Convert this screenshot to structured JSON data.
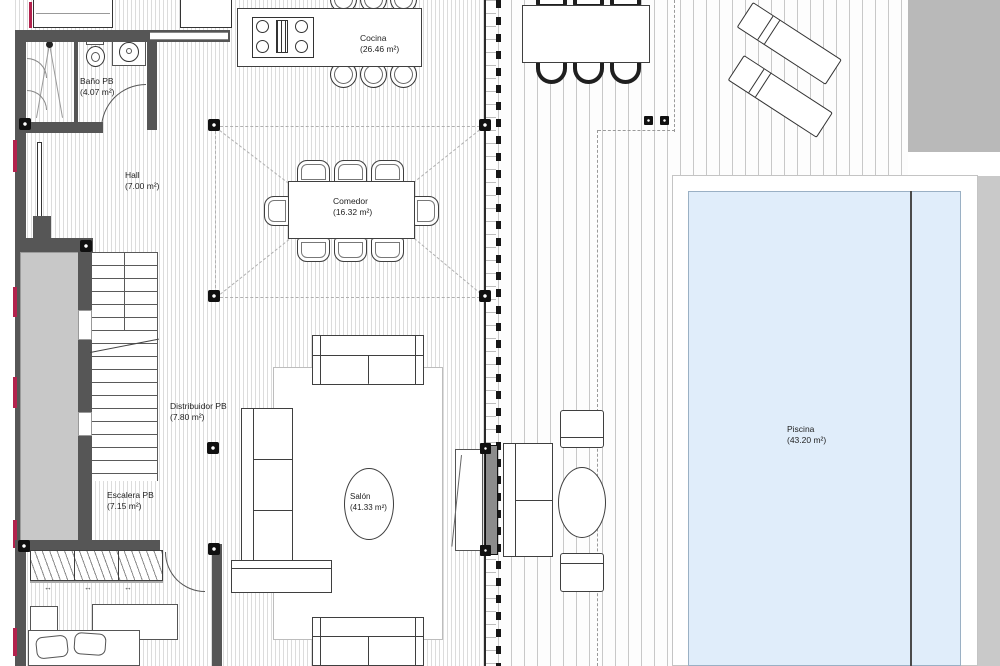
{
  "plan": {
    "type": "residential-floor-plan",
    "rooms": [
      {
        "name": "Baño PB",
        "area": "(4.07 m²)"
      },
      {
        "name": "Hall",
        "area": "(7.00 m²)"
      },
      {
        "name": "Cocina",
        "area": "(26.46 m²)"
      },
      {
        "name": "Comedor",
        "area": "(16.32 m²)"
      },
      {
        "name": "Distribuidor PB",
        "area": "(7.80 m²)"
      },
      {
        "name": "Escalera PB",
        "area": "(7.15 m²)"
      },
      {
        "name": "Salón",
        "area": "(41.33 m²)"
      },
      {
        "name": "Piscina",
        "area": "(43.20 m²)"
      }
    ],
    "symbols": {
      "wardrobe_arrow": "↔"
    },
    "colors": {
      "pool_fill": "#e0edfa",
      "wall": "#565656",
      "accent_marks": "#b3224d",
      "terrace_block": "#b9b9b9"
    }
  }
}
